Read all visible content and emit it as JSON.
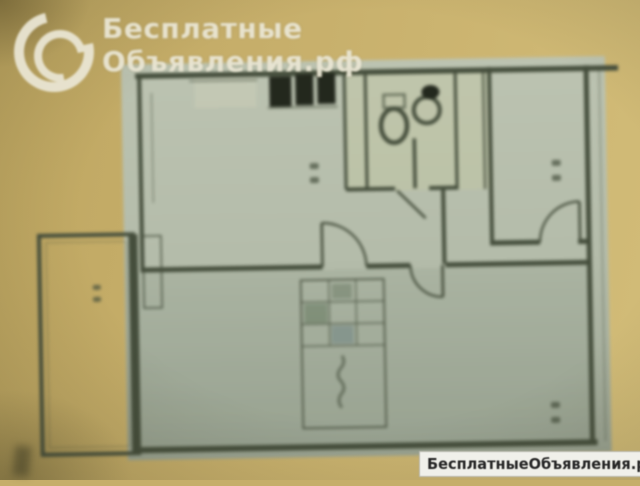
{
  "colors": {
    "background": "#c6ae6a",
    "paper": "#b6bdac",
    "paper_dark": "#9aa392",
    "wall": "#454e3c",
    "dark_fixture": "#23281d",
    "logo_text": "#eae6d4",
    "footer_bg": "#f0f0ea",
    "footer_text": "#262626"
  },
  "watermark_logo": {
    "icon": "swirl-crescents-icon",
    "line1": "Бесплатные",
    "line2": "Объявления.рф"
  },
  "watermark_footer": {
    "text": "БесплатныеОбъявления.рф"
  },
  "floor_plan": {
    "kind": "blurred photo of an apartment floor plan",
    "features": [
      "outer walls",
      "top-left room with window and built-in closets",
      "bathroom with toilet and sink symbols",
      "kitchen with door arc",
      "hallway with door arcs",
      "large bottom room with stamp table block",
      "balcony on left side",
      "illegible room-area number marks"
    ]
  }
}
